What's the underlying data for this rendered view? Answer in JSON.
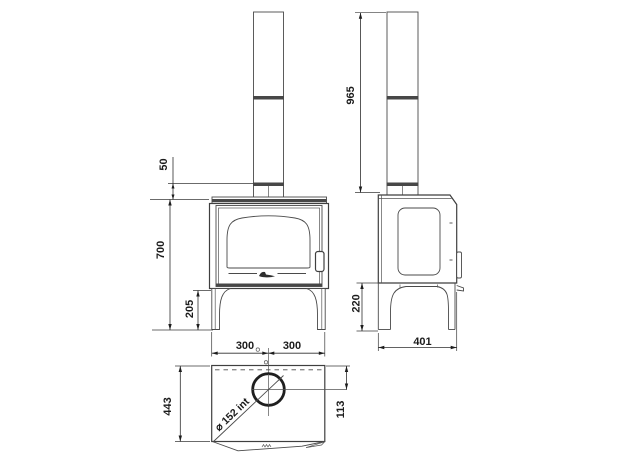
{
  "meta": {
    "type": "technical dimensional drawing",
    "subject": "wood-burning stove with flue pipe, three orthographic views",
    "units": "mm"
  },
  "front_view": {
    "dim_flue_collar_height": "50",
    "dim_body_height": "700",
    "dim_leg_height": "205",
    "dim_half_width_left": "300",
    "dim_half_width_right": "300"
  },
  "side_view": {
    "dim_total_height": "965",
    "dim_leg_clearance": "220",
    "dim_depth": "401"
  },
  "top_view": {
    "dim_depth": "443",
    "dim_flue_center_offset": "113",
    "dim_flue_diameter": "⌀ 152 int"
  },
  "colors": {
    "background": "#ffffff",
    "outline": "#3f3f3f",
    "joint_band": "#474747",
    "dimension_text": "#1c1c1c"
  }
}
